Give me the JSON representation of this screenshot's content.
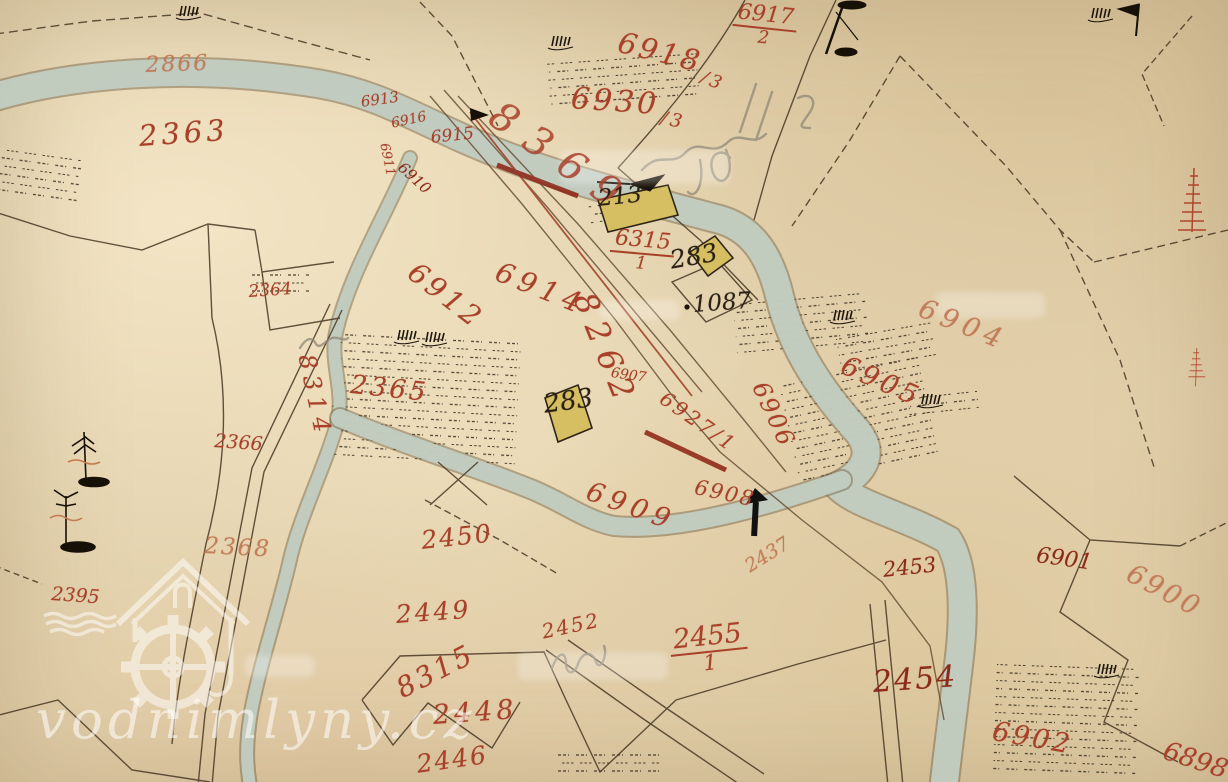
{
  "watermark": {
    "text": "vodnimlyny.cz"
  },
  "parcels": {
    "p2866": "2866",
    "p2363": "2363",
    "p2364": "2364",
    "p2365": "2365",
    "p2366": "2366",
    "p2368": "2368",
    "p2395": "2395",
    "p8314": "8314",
    "p8315": "8315",
    "p8262": "8262",
    "p8369": "8369",
    "p2450": "2450",
    "p2449": "2449",
    "p2448": "2448",
    "p2446": "2446",
    "p2452": "2452",
    "p2437": "2437",
    "p2453": "2453",
    "p2454": "2454",
    "p6898": "6898",
    "p6900": "6900",
    "p6901": "6901",
    "p6902": "6902",
    "p6904": "6904",
    "p6905": "6905",
    "p6906": "6906",
    "p6907": "6907",
    "p6908": "6908",
    "p6909": "6909",
    "p6910": "6910",
    "p6911": "6911",
    "p6912": "6912",
    "p6913": "6913",
    "p6914": "6914",
    "p6915": "6915",
    "p6916": "6916",
    "p6927": "6927/1"
  },
  "fractions": {
    "f6917": {
      "num": "6917",
      "den": "2"
    },
    "f6918": {
      "num": "6918",
      "den": "/3"
    },
    "f6930": {
      "num": "6930",
      "den": "/3"
    },
    "f6315": {
      "num": "6315",
      "den": "1"
    },
    "f2455": {
      "num": "2455",
      "den": "1"
    }
  },
  "buildings": {
    "b213": "213",
    "b283_upper": "283",
    "b283_lower": "283",
    "b1087": "1087"
  },
  "symbols": {
    "river": "watercourse-band",
    "tally": "meadow-grass-tally-icon",
    "tree": "deciduous-tree-icon",
    "flag": "survey-flag-icon",
    "pump": "well-pump-icon",
    "red_tree": "orchard-tree-icon",
    "watermill_logo": "watermill-house-waterwheel-icon"
  },
  "colors": {
    "paper": "#e4d2ae",
    "river_fill": "#c2cfc2",
    "river_edge": "#75654a",
    "red_ink": "#a8402a",
    "light_red_ink": "#c07550",
    "dark_red_ink": "#8c2a1a",
    "black_ink": "#2b2114",
    "pencil": "#8f8878",
    "boundary": "#4d3c27",
    "building_fill": "#d6bf62",
    "watermark_white": "#ffffff"
  }
}
